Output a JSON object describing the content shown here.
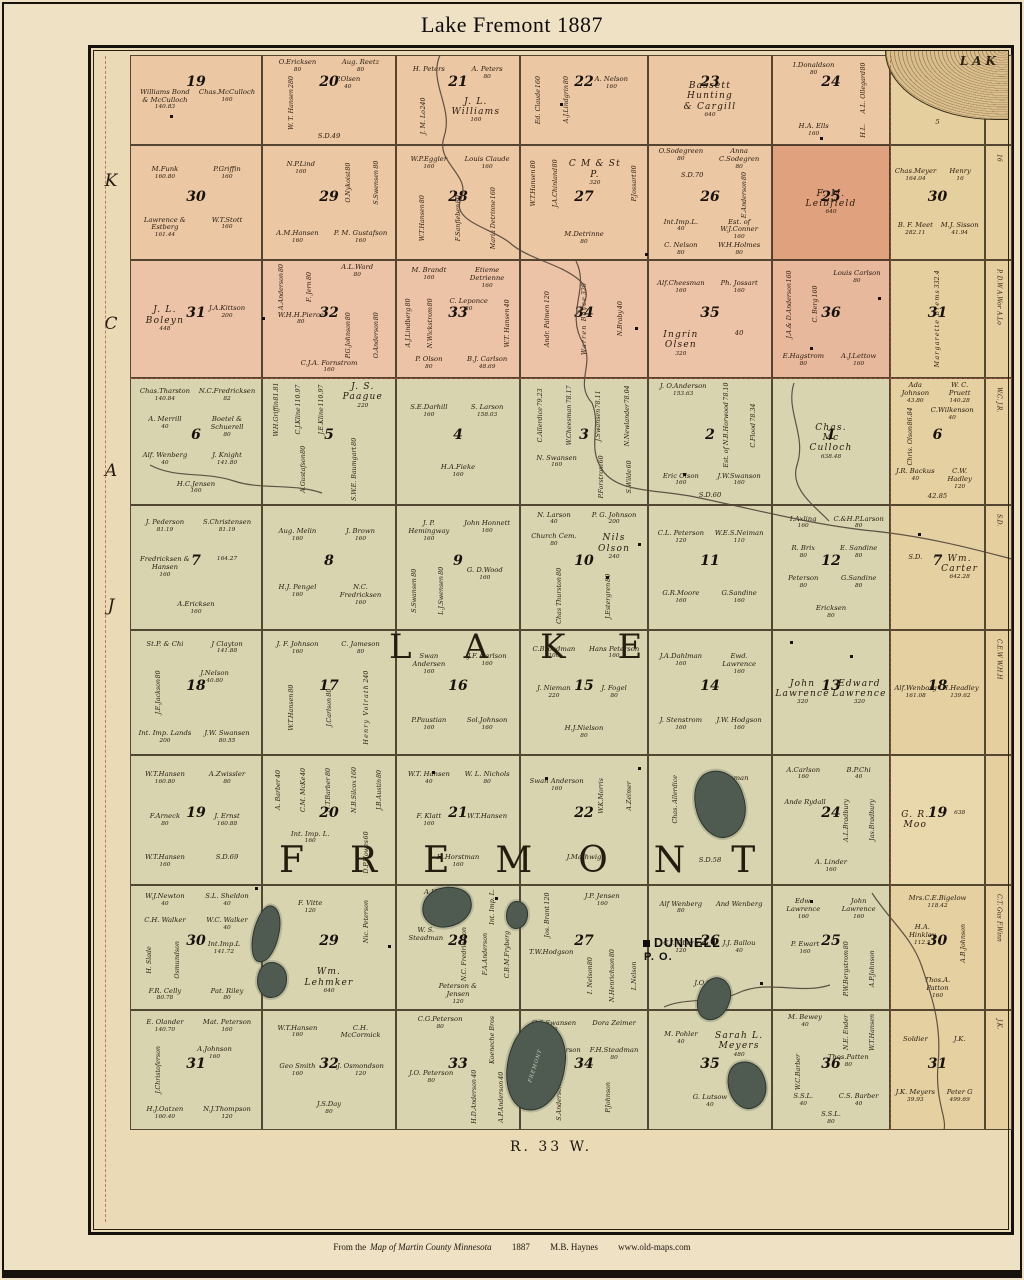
{
  "page": {
    "title": "Lake Fremont 1887",
    "range_label": "R. 33 W."
  },
  "footer": {
    "prefix": "From the",
    "source": "Map of Martin County  Minnesota",
    "year": "1887",
    "author": "M.B. Haynes",
    "site": "www.old-maps.com"
  },
  "margin_letters": [
    "K",
    "C",
    "A",
    "J"
  ],
  "overlay": {
    "township_lake": "LAKE",
    "township_fremont": "FREMONT",
    "po_name": "DUNNELL",
    "po_sub": "P. O.",
    "corner_lake_label": "LAK",
    "fremont_lake_label": "FREMONT"
  },
  "colors": {
    "pink_row": "#ebc7a3",
    "pink_row3": "#ecc3a6",
    "green_row": "#d8d4b0",
    "tan_col": "#e6cf9e",
    "leibfield": "#e0a17e",
    "lake_fill": "#4f5b50",
    "boundary_red": "#b4543c",
    "ink": "#27190d"
  },
  "rows": [
    {
      "tint": "#ebc7a3",
      "col7_tint": "#e6cf9e",
      "edge": [],
      "sections": [
        {
          "n": "19",
          "p": [
            "Williams Bond & McCulloch|140.83",
            "Chas.McCulloch|160"
          ]
        },
        {
          "n": "20",
          "p": [
            "O.Ericksen|80",
            "Aug. Reetz|80",
            "^W. T. Hansen|280",
            "P.Olsen|40",
            "S.D.49|"
          ]
        },
        {
          "n": "21",
          "p": [
            "H. Peters|",
            "A. Peters|80",
            "^J. M. Lo|240",
            "*J. L. Williams|160"
          ]
        },
        {
          "n": "22",
          "p": [
            "^Ed. Claude|160",
            "^A.J.Lindgrin|80",
            "A. Nelson|160"
          ]
        },
        {
          "n": "23",
          "p": [
            "*Bassett Hunting & Cargill|640"
          ]
        },
        {
          "n": "24",
          "p": [
            "I.Donaldson|80",
            "^A.L. Ollegard|80",
            "H.A. Ells|160",
            "^H.L.|"
          ]
        },
        {
          "n": "",
          "p": [
            "G.R.Maore|193.01",
            "4|",
            "5|"
          ]
        }
      ]
    },
    {
      "tint": "#ebc7a3",
      "col7_tint": "#e6cf9e",
      "edge": [
        "16"
      ],
      "sections": [
        {
          "n": "30",
          "p": [
            "M.Funk|160.80",
            "P.Griffin|160",
            "Lawrence & Estberg|161.44",
            "W.T.Stott|160"
          ]
        },
        {
          "n": "29",
          "p": [
            "N.P.Lind|160",
            "^O.Nykoist|80",
            "^S.Swensen|80",
            "A.M.Hansen|160",
            "P. M. Gustafson|160"
          ]
        },
        {
          "n": "28",
          "p": [
            "W.P.Eggler|160",
            "Louis Claude|160",
            "^W.T.Hansen|80",
            "^F.Sanfleben|80",
            "^Maria Detrinne|160"
          ]
        },
        {
          "n": "27",
          "p": [
            "^W.T.Hansen|80",
            "^J.A.Chinland|80",
            "*C M & St P.|320",
            "^P.Jossart|80",
            "M.Detrinne|80"
          ]
        },
        {
          "n": "26",
          "p": [
            "O.Sodegreen|80",
            "Anna C.Sodegren|80",
            "S.D.70|",
            "^E.Anderson|80",
            "Int.Imp.L.|40",
            "Est. of W.J.Conner|160",
            "C. Nelson|80",
            "W.H.Holmes|80"
          ]
        },
        {
          "n": "25",
          "tint": "#e0a17e",
          "p": [
            "*F. M. Leibfield|640"
          ]
        },
        {
          "n": "30",
          "p": [
            "Chas.Meyer|164.04",
            "Henry|16",
            "B. F. Meet|282.11",
            "M.J. Sisson|41.94"
          ]
        }
      ]
    },
    {
      "tint": "#ecc3a6",
      "col7_tint": "#e6cf9e",
      "edge": [
        "P. D.W",
        "A.Wor",
        "A.Lo"
      ],
      "sections": [
        {
          "n": "31",
          "p": [
            "*J. L. Boleyn|448",
            "J.A.Kittson|200"
          ]
        },
        {
          "n": "32",
          "p": [
            "^A.Anderson|80",
            "^F. Jern|80",
            "A.L.Ward|80",
            "W.H.H.Pierce|80",
            "^P.G.Johnson|80",
            "^O.Anderson|80",
            "C.J.A. Fornstrom|160"
          ]
        },
        {
          "n": "33",
          "p": [
            "M. Brandt|160",
            "Etieme Detrienne|160",
            "^A.J.Lindberg|80",
            "^N.Wickstrom|80",
            "C. Leponce|80",
            "^W.T. Hansen|40",
            "P. Olson|80",
            "B.J. Carlson|48.69"
          ]
        },
        {
          "n": "34",
          "p": [
            "^Andr. Palmen|120",
            "^*Warren Boyce|320",
            "^N.Braby|40"
          ]
        },
        {
          "n": "35",
          "p": [
            "Alf.Cheesman|160",
            "Ph. Jossart|160",
            "*Ingrin Olsen|320",
            "40|"
          ]
        },
        {
          "n": "36",
          "tint": "#e8b89c",
          "p": [
            "^J.A.& D.Anderson|160",
            "^C. Berg|160",
            "Louis Carlson|80",
            "E.Hagstrom|80",
            "A.J.Lettow|160"
          ]
        },
        {
          "n": "31",
          "p": [
            "^*Margarette Brems|332.4"
          ]
        }
      ]
    },
    {
      "tint": "#d8d4b0",
      "col7_tint": "#e4d0a0",
      "edge": [
        "W.C.",
        "J.R."
      ],
      "sections": [
        {
          "n": "6",
          "p": [
            "Chas.Tharston|140.84",
            "N.C.Fredricksen|82",
            "A. Merrill|40",
            "Boetel & Schuerell|80",
            "Alf. Wenberg|40",
            "J. Knight|141.80",
            "H.C.Jensen|160"
          ]
        },
        {
          "n": "5",
          "p": [
            "^W.H.Griffin|81.81",
            "^C.J.Kline|110.97",
            "^J.E.Kline|110.97",
            "*J. S. Paague|220",
            "^A.Gustafson|80",
            "^S.W.E. Baumgart|80"
          ]
        },
        {
          "n": "4",
          "p": [
            "S.E.Darhill|160",
            "S. Larson|158.03",
            "H.A.Fieke|160"
          ]
        },
        {
          "n": "3",
          "p": [
            "^C.Allerdice|79.23",
            "^W.Cheesman|78.17",
            "^J.Swansen|78.11",
            "^N.Newlander|78.04",
            "N. Swansen|160",
            "^P.Forstrom|60",
            "^S.Wilde|60"
          ]
        },
        {
          "n": "2",
          "p": [
            "J. O.Anderson|153.63",
            "^Est. of N.B.Horwood|78.10",
            "^C.Flood|78.34",
            "Eric Olson|160",
            "J.W.Swanson|160",
            "S.D.60|"
          ]
        },
        {
          "n": "1",
          "p": [
            "*Chas. Mc Culloch|638.48"
          ]
        },
        {
          "n": "6",
          "p": [
            "Ada Johnson|43.80",
            "W. C. Pruett|140.28",
            "^Chris. Olson|86.84",
            "C.Wilkenson|40",
            "J.R. Backus|40",
            "C.W. Hadley|120",
            "42.85|"
          ]
        }
      ]
    },
    {
      "tint": "#d8d4b0",
      "col7_tint": "#e4d0a0",
      "edge": [
        "S.D."
      ],
      "sections": [
        {
          "n": "7",
          "p": [
            "J. Pederson|81.19",
            "S.Christensen|81.19",
            "Fredricksen & Hansen|160",
            "|164.27",
            "A.Ericksen|160"
          ]
        },
        {
          "n": "8",
          "p": [
            "Aug. Melin|160",
            "J. Brown|160",
            "H.J. Pengel|160",
            "N.C. Fredricksen|160"
          ]
        },
        {
          "n": "9",
          "p": [
            "J. P. Hemingway|160",
            "John Honnett|160",
            "^S.Swansen|80",
            "^L.J.Swensen|80",
            "G. D.Wood|160"
          ]
        },
        {
          "n": "10",
          "p": [
            "N. Larson|40",
            "P. G. Johnson|200",
            "Church Cem.|80",
            "*Nils Olson|240",
            "^Chas Thurston|80",
            "^J.Estergren|80"
          ]
        },
        {
          "n": "11",
          "p": [
            "C.L. Peterson|120",
            "W.E.S.Neiman|110",
            "G.R.Moore|160",
            "G.Sandine|160"
          ]
        },
        {
          "n": "12",
          "p": [
            "I.Axling|160",
            "C.&H.P.Larson|80",
            "R. Brix|80",
            "E. Sandine|80",
            "Peterson|80",
            "G.Sandine|80",
            "Ericksen|80"
          ]
        },
        {
          "n": "7",
          "p": [
            "S.D.|",
            "*Wm. Carter|642.28"
          ]
        }
      ]
    },
    {
      "tint": "#d8d4b0",
      "col7_tint": "#e4d0a0",
      "edge": [
        "C.E.W",
        "W.H.H"
      ],
      "sections": [
        {
          "n": "18",
          "p": [
            "St.P. & Chi|",
            "J Clayton|141.88",
            "^J.E.Jackson|80",
            "J.Nelson|40.80",
            "Int. Imp. Lands|200",
            "J.W. Swansen|80.55"
          ]
        },
        {
          "n": "17",
          "p": [
            "J. F. Johnson|160",
            "C. Jameson|80",
            "^W.T.Hansen|80",
            "^J.Carlson|80",
            "^*Henry Volrath|240"
          ]
        },
        {
          "n": "16",
          "p": [
            "Swan Andersen|160",
            "J.F. Carlson|160",
            "P.Paustian|160",
            "Sol.Johnson|160"
          ]
        },
        {
          "n": "15",
          "p": [
            "C.Broadman|100",
            "Hans Peterson|160",
            "J. Nieman|220",
            "J. Fogel|80",
            "H.J.Nielson|80"
          ]
        },
        {
          "n": "14",
          "p": [
            "J.A.Dahlman|160",
            "Ewd. Lawrence|160",
            "J. Stenstrom|160",
            "J.W. Hodgson|160"
          ]
        },
        {
          "n": "13",
          "p": [
            "*John Lawrence|320",
            "*Edward Lawrence|320"
          ]
        },
        {
          "n": "18",
          "p": [
            "Alf.Wenborg|161.08",
            "H.Headley|139.62"
          ]
        }
      ]
    },
    {
      "tint": "#d8d4b0",
      "col7_tint": "#e9d8ab",
      "edge": [],
      "sections": [
        {
          "n": "19",
          "p": [
            "W.T.Hansen|160.80",
            "A.Zwissler|80",
            "F.Arneck|80",
            "J. Ernst|160.88",
            "W.T.Hansen|160",
            "S.D.69|"
          ]
        },
        {
          "n": "20",
          "p": [
            "^A. Barber|40",
            "^C.M. McKe|40",
            "^N.T.Barber|80",
            "^N.B.Silcox|160",
            "^J.B.Austin|80",
            "Int. Imp. L.|160",
            "^D.P.Howes|60"
          ]
        },
        {
          "n": "21",
          "p": [
            "W.T. Hansen|40",
            "W. L. Nichols|80",
            "F. Klatt|160",
            "W.T.Hansen|",
            "H.Horstman|160"
          ]
        },
        {
          "n": "22",
          "p": [
            "Swan Anderson|160",
            "^W.K.Morris|",
            "^A.Zeimer|",
            "J.Mathwig|"
          ]
        },
        {
          "n": "23",
          "p": [
            "^Chas. Allerdice|",
            "C.F.Bauman|",
            "S.D.58|"
          ]
        },
        {
          "n": "24",
          "p": [
            "A.Carlson|160",
            "B.P.Chi|40",
            "Ande Rydall|",
            "^A.L.Bradbury|",
            "^Jas.Bradbury|",
            "A. Linder|160"
          ]
        },
        {
          "n": "19",
          "p": [
            "*G. R. Moo|",
            "|638"
          ]
        }
      ]
    },
    {
      "tint": "#d8d4b0",
      "col7_tint": "#e4d0a0",
      "edge": [
        "C.T.",
        "Gus",
        "F.Winn"
      ],
      "sections": [
        {
          "n": "30",
          "p": [
            "W.J.Newton|40",
            "S.L. Sheldon|40",
            "C.H. Walker|",
            "W.C. Walker|40",
            "^H. Slade|",
            "^Osmundson|",
            "Int.Imp.L|141.72",
            "F.R. Celly|80.78",
            "Pat. Riley|80"
          ]
        },
        {
          "n": "29",
          "p": [
            "F. Vitte|120",
            "^Nic. Peterson|",
            "*Wm. Lehmker|640"
          ]
        },
        {
          "n": "28",
          "p": [
            "A.Hauser|",
            "^Int. Imp. L.|",
            "W. S. Steadman|",
            "^N.C. Fredrickson|",
            "^F.A.Anderson|",
            "^C.B.M.Fryberg|",
            "Peterson & Jensen|120"
          ]
        },
        {
          "n": "27",
          "p": [
            "^Jos. Brant|120",
            "J.P. Jensen|160",
            "T.W.Hodgson|",
            "^I. Nelson|80",
            "^N.Henrichson|80",
            "^L.Nelson|"
          ]
        },
        {
          "n": "26",
          "p": [
            "Alf Wenberg|80",
            "And Wenberg|",
            "C.J. Oberg|120",
            "J.J. Ballou|40",
            "J.O.Gates|80"
          ]
        },
        {
          "n": "25",
          "p": [
            "Edw. Lawrence|160",
            "John Lawrence|160",
            "P. Ewart|160",
            "^P.W.Bergstrom|80",
            "^A.P.Johnson|"
          ]
        },
        {
          "n": "30",
          "p": [
            "Mrs.C.E.Bigelow|118.42",
            "H.A. Hinkley|112.5",
            "^A.B.Johnson|",
            "Thos.A. Patton|160"
          ]
        }
      ]
    },
    {
      "tint": "#d8d4b0",
      "col7_tint": "#e4d0a0",
      "edge": [
        "J.K."
      ],
      "sections": [
        {
          "n": "31",
          "p": [
            "E. Olander|140.70",
            "Mat. Peterson|160",
            "^J.Christoferson|",
            "A.Johnson|160",
            "H.J.Oatzen|160.40",
            "N.J.Thompson|120"
          ]
        },
        {
          "n": "32",
          "p": [
            "W.T.Hansen|160",
            "C.H. McCormick|",
            "Geo Smith|160",
            "J. Osmondson|120",
            "J.S.Day|80"
          ]
        },
        {
          "n": "33",
          "p": [
            "C.G.Peterson|80",
            "^Koeneche Bros|",
            "J.O. Peterson|80",
            "^H.D.Anderson|40",
            "^A.P.Anderson|40"
          ]
        },
        {
          "n": "34",
          "p": [
            "C.S.Swansen|80",
            "Dora Zeimer|",
            "S. M. Batterson|",
            "F.H.Steadman|80",
            "^S.Anderson|80",
            "^P.Johnson|"
          ]
        },
        {
          "n": "35",
          "p": [
            "M. Pohler|40",
            "*Sarah L. Meyers|480",
            "G. Lutsow|40"
          ]
        },
        {
          "n": "36",
          "p": [
            "M. Bewey|40",
            "^N.E. Ender|",
            "^W.T.Hansen|",
            "^W.C.Barber|",
            "Thos.Patten|80",
            "S.S.L.|40",
            "C.S. Barber|40",
            "S.S.L.|80"
          ]
        },
        {
          "n": "31",
          "p": [
            "Soldier|",
            "J.K.|",
            "J.K. Meyers|39.93",
            "Peter G|499.69"
          ]
        }
      ]
    }
  ]
}
